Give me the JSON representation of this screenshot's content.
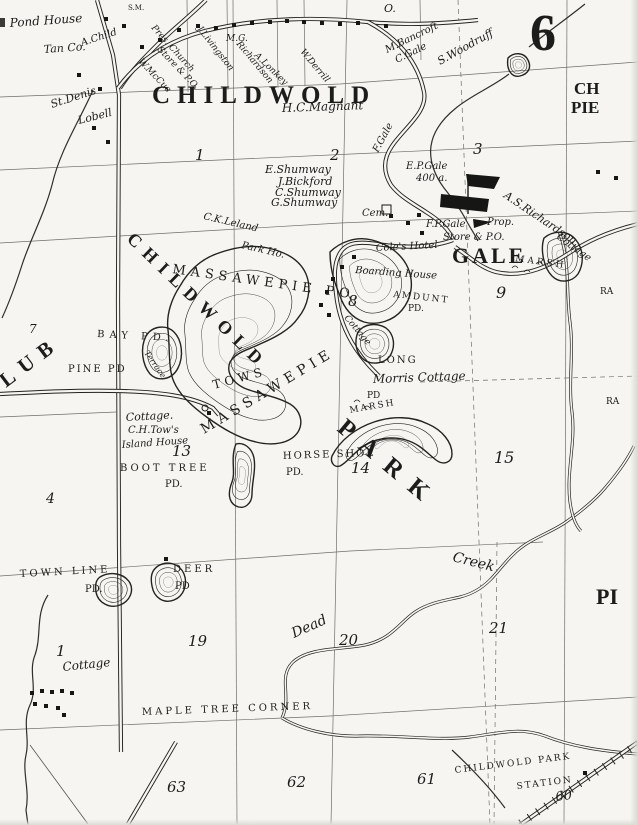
{
  "map": {
    "colors": {
      "paper": "#f6f5f2",
      "ink": "#23231f"
    },
    "labels": [
      {
        "t": "Pond House",
        "x": 10,
        "y": 27,
        "s": 12,
        "r": -4
      },
      {
        "t": "Tan Co.",
        "x": 44,
        "y": 53,
        "s": 11,
        "r": -4
      },
      {
        "t": "A.Child",
        "x": 82,
        "y": 46,
        "s": 10,
        "r": -18
      },
      {
        "t": "S.M.",
        "x": 128,
        "y": 10,
        "c": "caps",
        "s": 7
      },
      {
        "t": "O.",
        "x": 384,
        "y": 12,
        "c": "num",
        "s": 11
      },
      {
        "t": "St.Denis",
        "x": 52,
        "y": 108,
        "s": 11,
        "r": -18
      },
      {
        "t": "Lobell",
        "x": 79,
        "y": 124,
        "s": 11,
        "r": -14
      },
      {
        "t": "Pres. Church",
        "x": 151,
        "y": 28,
        "s": 9,
        "r": 48
      },
      {
        "t": "Store & P.O.",
        "x": 157,
        "y": 50,
        "s": 9,
        "r": 46
      },
      {
        "t": "W.McCue",
        "x": 138,
        "y": 62,
        "s": 9,
        "r": 46
      },
      {
        "t": "J.Livingston",
        "x": 197,
        "y": 29,
        "s": 9,
        "r": 52
      },
      {
        "t": "M.G.",
        "x": 226,
        "y": 41,
        "s": 9
      },
      {
        "t": "Richardson",
        "x": 236,
        "y": 44,
        "s": 9,
        "r": 50
      },
      {
        "t": "A.Lonkey",
        "x": 254,
        "y": 56,
        "s": 9,
        "r": 44
      },
      {
        "t": "W.Derrill",
        "x": 300,
        "y": 52,
        "s": 9,
        "r": 50
      },
      {
        "t": "M.Bancroft",
        "x": 387,
        "y": 53,
        "s": 10,
        "r": -26
      },
      {
        "t": "C.Gale",
        "x": 397,
        "y": 63,
        "s": 10,
        "r": -26
      },
      {
        "t": "S.Woodruff",
        "x": 440,
        "y": 65,
        "s": 11,
        "r": -29
      },
      {
        "t": "CHILDWOLD",
        "x": 152,
        "y": 103,
        "c": "title",
        "s": 25,
        "ls": 7
      },
      {
        "t": "H.C.Magnant",
        "x": 282,
        "y": 112,
        "s": 12,
        "r": -2
      },
      {
        "t": "F.Gale",
        "x": 378,
        "y": 153,
        "s": 10,
        "r": -62
      },
      {
        "t": "1",
        "x": 195,
        "y": 160,
        "c": "num",
        "s": 15
      },
      {
        "t": "2",
        "x": 330,
        "y": 160,
        "c": "num",
        "s": 15
      },
      {
        "t": "3",
        "x": 473,
        "y": 154,
        "c": "num",
        "s": 15
      },
      {
        "t": "E.P.Gale",
        "x": 406,
        "y": 169,
        "s": 10
      },
      {
        "t": "400 a.",
        "x": 416,
        "y": 181,
        "s": 10
      },
      {
        "t": "E.Shumway",
        "x": 265,
        "y": 173,
        "s": 11
      },
      {
        "t": "J.Bickford",
        "x": 278,
        "y": 185,
        "s": 11
      },
      {
        "t": "C.Shumway",
        "x": 275,
        "y": 196,
        "s": 11
      },
      {
        "t": "G.Shumway",
        "x": 271,
        "y": 206,
        "s": 11
      },
      {
        "t": "Cem.",
        "x": 362,
        "y": 216,
        "s": 10
      },
      {
        "t": "C.K.Leland",
        "x": 203,
        "y": 219,
        "s": 10,
        "r": 13
      },
      {
        "t": "Park Ho.",
        "x": 241,
        "y": 248,
        "s": 10,
        "r": 13
      },
      {
        "t": "A.S.Richardson",
        "x": 503,
        "y": 197,
        "s": 11,
        "r": 34
      },
      {
        "t": "MASSAWEPIE PO.",
        "x": 172,
        "y": 273,
        "c": "caps",
        "s": 13,
        "ls": 5,
        "r": 8
      },
      {
        "t": "Cole's Hotel",
        "x": 376,
        "y": 251,
        "s": 10,
        "r": -3
      },
      {
        "t": "GALE",
        "x": 452,
        "y": 263,
        "c": "big",
        "s": 22,
        "ls": 3
      },
      {
        "t": "F.P.Gale",
        "x": 426,
        "y": 227,
        "s": 10
      },
      {
        "t": "Prop.",
        "x": 487,
        "y": 225,
        "s": 10
      },
      {
        "t": "Store & P.O.",
        "x": 443,
        "y": 240,
        "s": 10
      },
      {
        "t": "Boarding House",
        "x": 355,
        "y": 273,
        "s": 10,
        "r": 4
      },
      {
        "t": "Cottage",
        "x": 556,
        "y": 238,
        "s": 10,
        "r": 36
      },
      {
        "t": "MARSH",
        "x": 515,
        "y": 261,
        "c": "caps",
        "s": 9,
        "ls": 3,
        "r": 8
      },
      {
        "t": "9",
        "x": 496,
        "y": 298,
        "c": "num",
        "s": 16
      },
      {
        "t": "RA",
        "x": 600,
        "y": 294,
        "c": "caps",
        "s": 9
      },
      {
        "t": "CH",
        "x": 574,
        "y": 94,
        "c": "big",
        "s": 17
      },
      {
        "t": "PIE",
        "x": 571,
        "y": 113,
        "c": "big",
        "s": 17
      },
      {
        "t": "6",
        "x": 530,
        "y": 50,
        "c": "big",
        "s": 52
      },
      {
        "t": "CHILDWOLD",
        "x": 126,
        "y": 240,
        "c": "big",
        "s": 18,
        "ls": 8,
        "r": 44
      },
      {
        "t": "AMDUNT",
        "x": 393,
        "y": 297,
        "c": "caps",
        "s": 9,
        "ls": 2,
        "r": 6
      },
      {
        "t": "PD.",
        "x": 408,
        "y": 311,
        "c": "caps",
        "s": 9
      },
      {
        "t": "8",
        "x": 348,
        "y": 306,
        "c": "num",
        "s": 15
      },
      {
        "t": "Cottage",
        "x": 344,
        "y": 318,
        "s": 9,
        "r": 50
      },
      {
        "t": "LUB",
        "x": 6,
        "y": 388,
        "c": "big",
        "s": 21,
        "ls": 9,
        "r": -37
      },
      {
        "t": "BAY PD.",
        "x": 97,
        "y": 337,
        "c": "caps",
        "s": 10,
        "ls": 5,
        "r": 3
      },
      {
        "t": "PINE PD",
        "x": 68,
        "y": 372,
        "c": "caps",
        "s": 10,
        "ls": 2
      },
      {
        "t": "Terrace",
        "x": 144,
        "y": 353,
        "s": 8,
        "r": 55
      },
      {
        "t": "TOWS",
        "x": 214,
        "y": 389,
        "c": "caps",
        "s": 12,
        "ls": 4,
        "r": -15
      },
      {
        "t": "MASSAWEPIE",
        "x": 204,
        "y": 434,
        "c": "caps",
        "s": 14,
        "ls": 5,
        "r": -31
      },
      {
        "t": "Cottage.",
        "x": 126,
        "y": 421,
        "s": 11,
        "r": -3
      },
      {
        "t": "C.H.Tow's",
        "x": 128,
        "y": 433,
        "s": 10
      },
      {
        "t": "Island House",
        "x": 122,
        "y": 448,
        "s": 10,
        "r": -4
      },
      {
        "t": "13",
        "x": 172,
        "y": 456,
        "c": "num",
        "s": 15
      },
      {
        "t": "BOOT TREE",
        "x": 120,
        "y": 471,
        "c": "caps",
        "s": 10,
        "ls": 3
      },
      {
        "t": "PD.",
        "x": 165,
        "y": 487,
        "c": "caps",
        "s": 10
      },
      {
        "t": "HORSE SHOE",
        "x": 283,
        "y": 459,
        "c": "caps",
        "s": 10,
        "ls": 2,
        "r": -2
      },
      {
        "t": "PD.",
        "x": 286,
        "y": 475,
        "c": "caps",
        "s": 10
      },
      {
        "t": "14",
        "x": 351,
        "y": 473,
        "c": "num",
        "s": 15
      },
      {
        "t": "LONG",
        "x": 378,
        "y": 363,
        "c": "caps",
        "s": 10,
        "ls": 2
      },
      {
        "t": "Morris Cottage",
        "x": 373,
        "y": 383,
        "s": 12,
        "r": -2
      },
      {
        "t": "PD",
        "x": 367,
        "y": 398,
        "c": "caps",
        "s": 9
      },
      {
        "t": "MARSH",
        "x": 350,
        "y": 413,
        "c": "caps",
        "s": 9,
        "ls": 2,
        "r": -10
      },
      {
        "t": "PARK",
        "x": 336,
        "y": 430,
        "c": "big",
        "s": 25,
        "ls": 14,
        "r": 40
      },
      {
        "t": "15",
        "x": 494,
        "y": 463,
        "c": "num",
        "s": 16
      },
      {
        "t": "RA",
        "x": 606,
        "y": 404,
        "c": "caps",
        "s": 9
      },
      {
        "t": "7",
        "x": 29,
        "y": 333,
        "c": "num",
        "s": 12
      },
      {
        "t": "4",
        "x": 46,
        "y": 503,
        "c": "num",
        "s": 14
      },
      {
        "t": "TOWN LINE",
        "x": 20,
        "y": 577,
        "c": "caps",
        "s": 10,
        "ls": 3,
        "r": -3
      },
      {
        "t": "PD.",
        "x": 85,
        "y": 592,
        "c": "caps",
        "s": 10
      },
      {
        "t": "DEER",
        "x": 173,
        "y": 572,
        "c": "caps",
        "s": 10,
        "ls": 3
      },
      {
        "t": "PD",
        "x": 175,
        "y": 589,
        "c": "caps",
        "s": 10
      },
      {
        "t": "19",
        "x": 188,
        "y": 646,
        "c": "num",
        "s": 15
      },
      {
        "t": "Dead",
        "x": 294,
        "y": 638,
        "s": 14,
        "r": -24
      },
      {
        "t": "20",
        "x": 339,
        "y": 645,
        "c": "num",
        "s": 15
      },
      {
        "t": "Creek",
        "x": 452,
        "y": 561,
        "s": 14,
        "r": 14
      },
      {
        "t": "21",
        "x": 489,
        "y": 633,
        "c": "num",
        "s": 15
      },
      {
        "t": "PI",
        "x": 596,
        "y": 604,
        "c": "big",
        "s": 22
      },
      {
        "t": "1",
        "x": 56,
        "y": 656,
        "c": "num",
        "s": 15
      },
      {
        "t": "Cottage",
        "x": 63,
        "y": 671,
        "s": 12,
        "r": -6
      },
      {
        "t": "MAPLE TREE CORNER",
        "x": 142,
        "y": 715,
        "c": "caps",
        "s": 10,
        "ls": 3,
        "r": -2
      },
      {
        "t": "63",
        "x": 167,
        "y": 792,
        "c": "num",
        "s": 15
      },
      {
        "t": "62",
        "x": 287,
        "y": 787,
        "c": "num",
        "s": 15
      },
      {
        "t": "61",
        "x": 417,
        "y": 784,
        "c": "num",
        "s": 15
      },
      {
        "t": "CHILDWOLD PARK",
        "x": 455,
        "y": 773,
        "c": "caps",
        "s": 9,
        "ls": 2,
        "r": -7
      },
      {
        "t": "STATION",
        "x": 517,
        "y": 789,
        "c": "caps",
        "s": 9,
        "ls": 2,
        "r": -7
      },
      {
        "t": "60",
        "x": 556,
        "y": 801,
        "c": "num",
        "s": 13,
        "r": -7
      }
    ],
    "buildings": [
      [
        104,
        17
      ],
      [
        122,
        24
      ],
      [
        140,
        45
      ],
      [
        158,
        38
      ],
      [
        177,
        28
      ],
      [
        196,
        24
      ],
      [
        214,
        26
      ],
      [
        232,
        23
      ],
      [
        250,
        21
      ],
      [
        268,
        20
      ],
      [
        285,
        19
      ],
      [
        302,
        20
      ],
      [
        320,
        21
      ],
      [
        338,
        22
      ],
      [
        356,
        21
      ],
      [
        384,
        24
      ],
      [
        77,
        73
      ],
      [
        98,
        87
      ],
      [
        92,
        126
      ],
      [
        106,
        140
      ],
      [
        417,
        213
      ],
      [
        406,
        221
      ],
      [
        420,
        231
      ],
      [
        389,
        214
      ],
      [
        352,
        255
      ],
      [
        340,
        265
      ],
      [
        331,
        277
      ],
      [
        325,
        290
      ],
      [
        319,
        303
      ],
      [
        327,
        313
      ],
      [
        207,
        411
      ],
      [
        164,
        557
      ],
      [
        583,
        771
      ],
      [
        30,
        691
      ],
      [
        40,
        689
      ],
      [
        50,
        690
      ],
      [
        60,
        689
      ],
      [
        70,
        691
      ],
      [
        33,
        702
      ],
      [
        44,
        704
      ],
      [
        56,
        706
      ],
      [
        62,
        713
      ],
      [
        596,
        170
      ],
      [
        614,
        176
      ]
    ]
  }
}
